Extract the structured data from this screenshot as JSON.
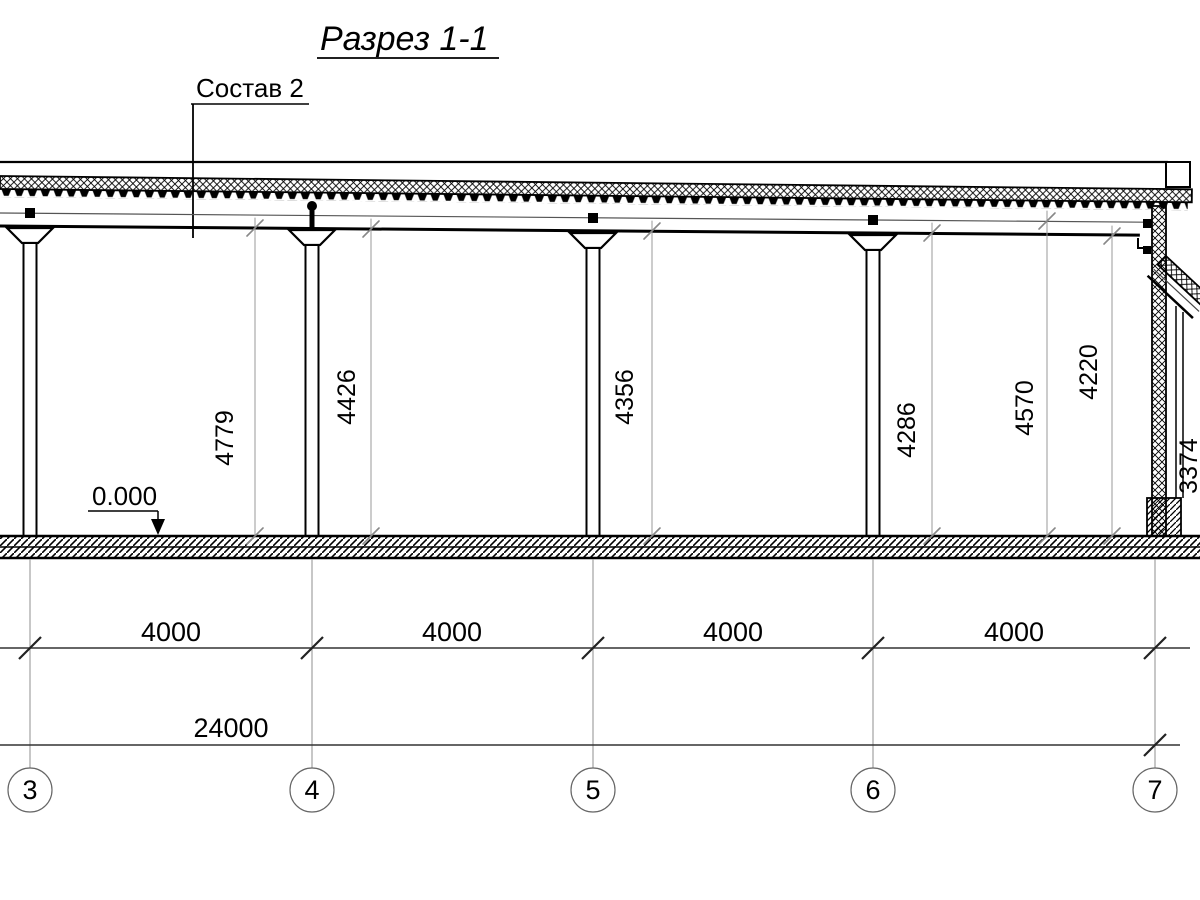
{
  "title": "Разрез 1-1",
  "annotations": {
    "composition": "Состав 2",
    "level": "0.000"
  },
  "height_dims": [
    "4779",
    "4426",
    "4356",
    "4286",
    "4570",
    "4220"
  ],
  "partial_height_dim": "3374",
  "bay_dims": [
    "4000",
    "4000",
    "4000",
    "4000"
  ],
  "total_dim": "24000",
  "grid_axes": [
    "3",
    "4",
    "5",
    "6",
    "7"
  ],
  "colors": {
    "line": "#000000",
    "dim_line": "#333333",
    "extension_line": "#999999",
    "background": "#ffffff"
  }
}
